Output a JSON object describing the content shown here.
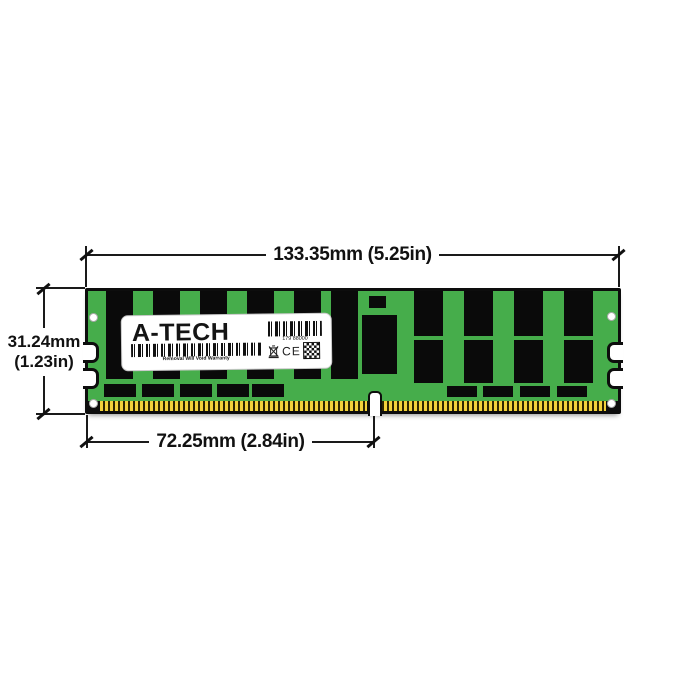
{
  "figure": {
    "type": "product-dimension-diagram",
    "subject": "A-Tech server memory module (DIMM) with physical dimensions"
  },
  "annotations": {
    "module_width": "133.35mm (5.25in)",
    "module_height_line1": "31.24mm",
    "module_height_line2": "(1.23in)",
    "contact_edge_width": "72.25mm (2.84in)"
  },
  "label": {
    "brand": "A-TECH",
    "part_number": "179 88000",
    "warranty_text": "Removal Will Void Warranty",
    "ce_mark": "CE"
  },
  "icons": [
    "barcode",
    "weee-crossed-bin-icon",
    "ce-mark",
    "qr-code-icon"
  ],
  "colors": {
    "pcb_green": "#46ad4b",
    "chip_black": "#0a0a0a",
    "pin_gold": "#f2d23b",
    "annotation": "#111111"
  }
}
